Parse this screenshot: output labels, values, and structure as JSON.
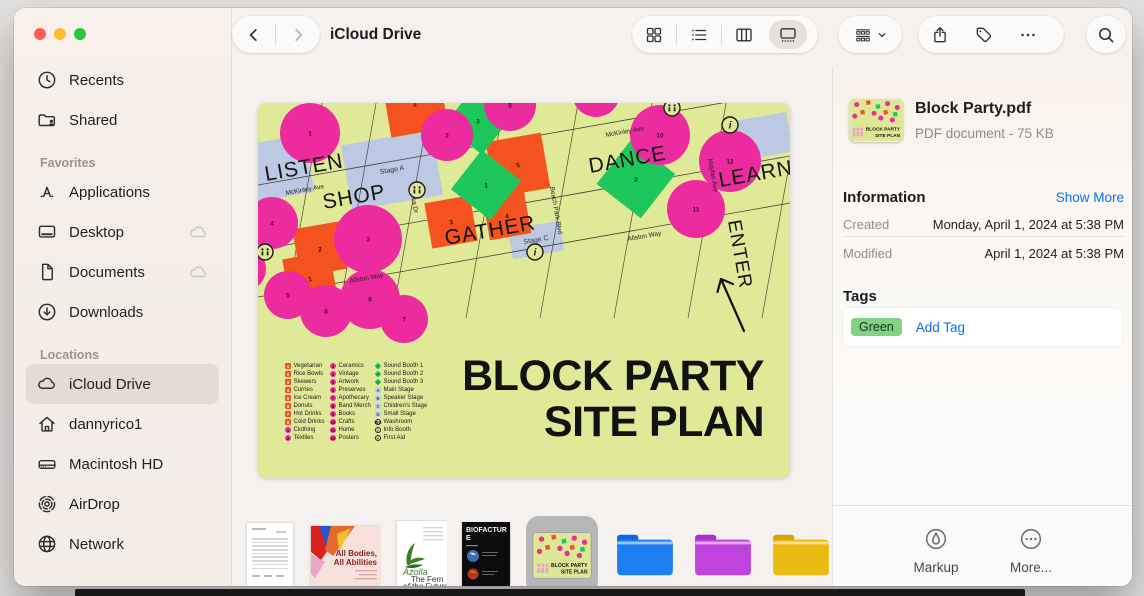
{
  "window": {
    "title": "iCloud Drive"
  },
  "toolbar": {
    "icons": [
      "chevron-left",
      "chevron-right",
      "view-grid",
      "view-list",
      "view-columns",
      "view-gallery",
      "group-by",
      "chevron-down",
      "share",
      "tag",
      "ellipsis",
      "search"
    ],
    "selected_view": "gallery"
  },
  "sidebar": {
    "sections": [
      {
        "title": "",
        "items": [
          {
            "label": "Recents",
            "icon": "clock"
          },
          {
            "label": "Shared",
            "icon": "shared-folder"
          }
        ]
      },
      {
        "title": "Favorites",
        "items": [
          {
            "label": "Applications",
            "icon": "app-store"
          },
          {
            "label": "Desktop",
            "icon": "desktop",
            "cloud": true
          },
          {
            "label": "Documents",
            "icon": "document",
            "cloud": true
          },
          {
            "label": "Downloads",
            "icon": "download"
          }
        ]
      },
      {
        "title": "Locations",
        "items": [
          {
            "label": "iCloud Drive",
            "icon": "cloud",
            "selected": true
          },
          {
            "label": "dannyrico1",
            "icon": "home"
          },
          {
            "label": "Macintosh HD",
            "icon": "hdd"
          },
          {
            "label": "AirDrop",
            "icon": "airdrop"
          },
          {
            "label": "Network",
            "icon": "globe"
          }
        ]
      }
    ]
  },
  "map": {
    "title_lines": [
      "BLOCK PARTY",
      "SITE PLAN"
    ],
    "zones": [
      "LISTEN",
      "SHOP",
      "GATHER",
      "DANCE",
      "LEARN",
      "ENTER"
    ],
    "streets": [
      "McKinley Ave",
      "Lorca Dr",
      "Beach Park Blvd",
      "Mayfair Ave",
      "Allston Way"
    ],
    "stage_labels": [
      "Stage A",
      "Stage C"
    ],
    "colors": {
      "bg": "#e0e998",
      "market": "#ec2b9f",
      "food": "#f4531f",
      "sound": "#1ec75c",
      "stage": "#bdc9e3",
      "ink": "#1d1d1f"
    },
    "legend": {
      "food": [
        {
          "n": "1",
          "label": "Vegetarian"
        },
        {
          "n": "2",
          "label": "Rice Bowls"
        },
        {
          "n": "3",
          "label": "Skewers"
        },
        {
          "n": "4",
          "label": "Curries"
        },
        {
          "n": "5",
          "label": "Ice Cream"
        },
        {
          "n": "6",
          "label": "Donuts"
        },
        {
          "n": "7",
          "label": "Hot Drinks"
        },
        {
          "n": "8",
          "label": "Cold Drinks"
        }
      ],
      "market": [
        {
          "n": "1",
          "label": "Clothing"
        },
        {
          "n": "2",
          "label": "Textiles"
        },
        {
          "n": "3",
          "label": "Ceramics"
        },
        {
          "n": "4",
          "label": "Vintage"
        },
        {
          "n": "5",
          "label": "Artwork"
        },
        {
          "n": "6",
          "label": "Preserves"
        },
        {
          "n": "7",
          "label": "Apothecary"
        },
        {
          "n": "8",
          "label": "Band Merch"
        },
        {
          "n": "9",
          "label": "Books"
        },
        {
          "n": "10",
          "label": "Crafts"
        },
        {
          "n": "11",
          "label": "Home"
        },
        {
          "n": "12",
          "label": "Posters"
        }
      ],
      "sound": [
        {
          "n": "1",
          "label": "Sound Booth 1"
        },
        {
          "n": "2",
          "label": "Sound Booth 2"
        },
        {
          "n": "3",
          "label": "Sound Booth 3"
        }
      ],
      "stages": [
        {
          "n": "A",
          "label": "Main Stage"
        },
        {
          "n": "B",
          "label": "Speaker Stage"
        },
        {
          "n": "C",
          "label": "Children's Stage"
        },
        {
          "n": "D",
          "label": "Small Stage"
        }
      ],
      "services": [
        {
          "n": "WC",
          "label": "Washroom"
        },
        {
          "n": "i",
          "label": "Info Booth"
        },
        {
          "n": "+",
          "label": "First Aid"
        }
      ]
    }
  },
  "thumbnails": [
    {
      "name": "agreement-document",
      "type": "doc",
      "selected": false
    },
    {
      "name": "all-bodies-poster",
      "type": "poster",
      "text_lines": [
        "All Bodies,",
        "All Abilities"
      ],
      "selected": false
    },
    {
      "name": "fern-article",
      "type": "fern",
      "title": "Azolla",
      "text_lines": [
        "The Fern",
        "of the Future"
      ],
      "selected": false
    },
    {
      "name": "biofacture-cover",
      "type": "dark",
      "title": "BIOFACTURE",
      "selected": false
    },
    {
      "name": "block-party-site-plan",
      "type": "siteplan",
      "selected": true
    },
    {
      "name": "blue-folder",
      "type": "folder",
      "color": "#1d7ef2",
      "tab": "#0f68da",
      "selected": false
    },
    {
      "name": "purple-folder",
      "type": "folder",
      "color": "#bf43dc",
      "tab": "#a92fc6",
      "selected": false
    },
    {
      "name": "yellow-folder",
      "type": "folder",
      "color": "#eaba12",
      "tab": "#d5a303",
      "selected": false
    }
  ],
  "info": {
    "file_name": "Block Party.pdf",
    "file_meta": "PDF document - 75 KB",
    "information_title": "Information",
    "show_more": "Show More",
    "rows": [
      {
        "label": "Created",
        "value": "Monday, April 1, 2024 at 5:38 PM"
      },
      {
        "label": "Modified",
        "value": "April 1, 2024 at 5:38 PM"
      }
    ],
    "tags_title": "Tags",
    "tags": [
      {
        "label": "Green",
        "bg": "#7fd383"
      }
    ],
    "add_tag": "Add Tag",
    "actions": [
      {
        "label": "Markup",
        "icon": "markup"
      },
      {
        "label": "More...",
        "icon": "more-circle"
      }
    ]
  }
}
